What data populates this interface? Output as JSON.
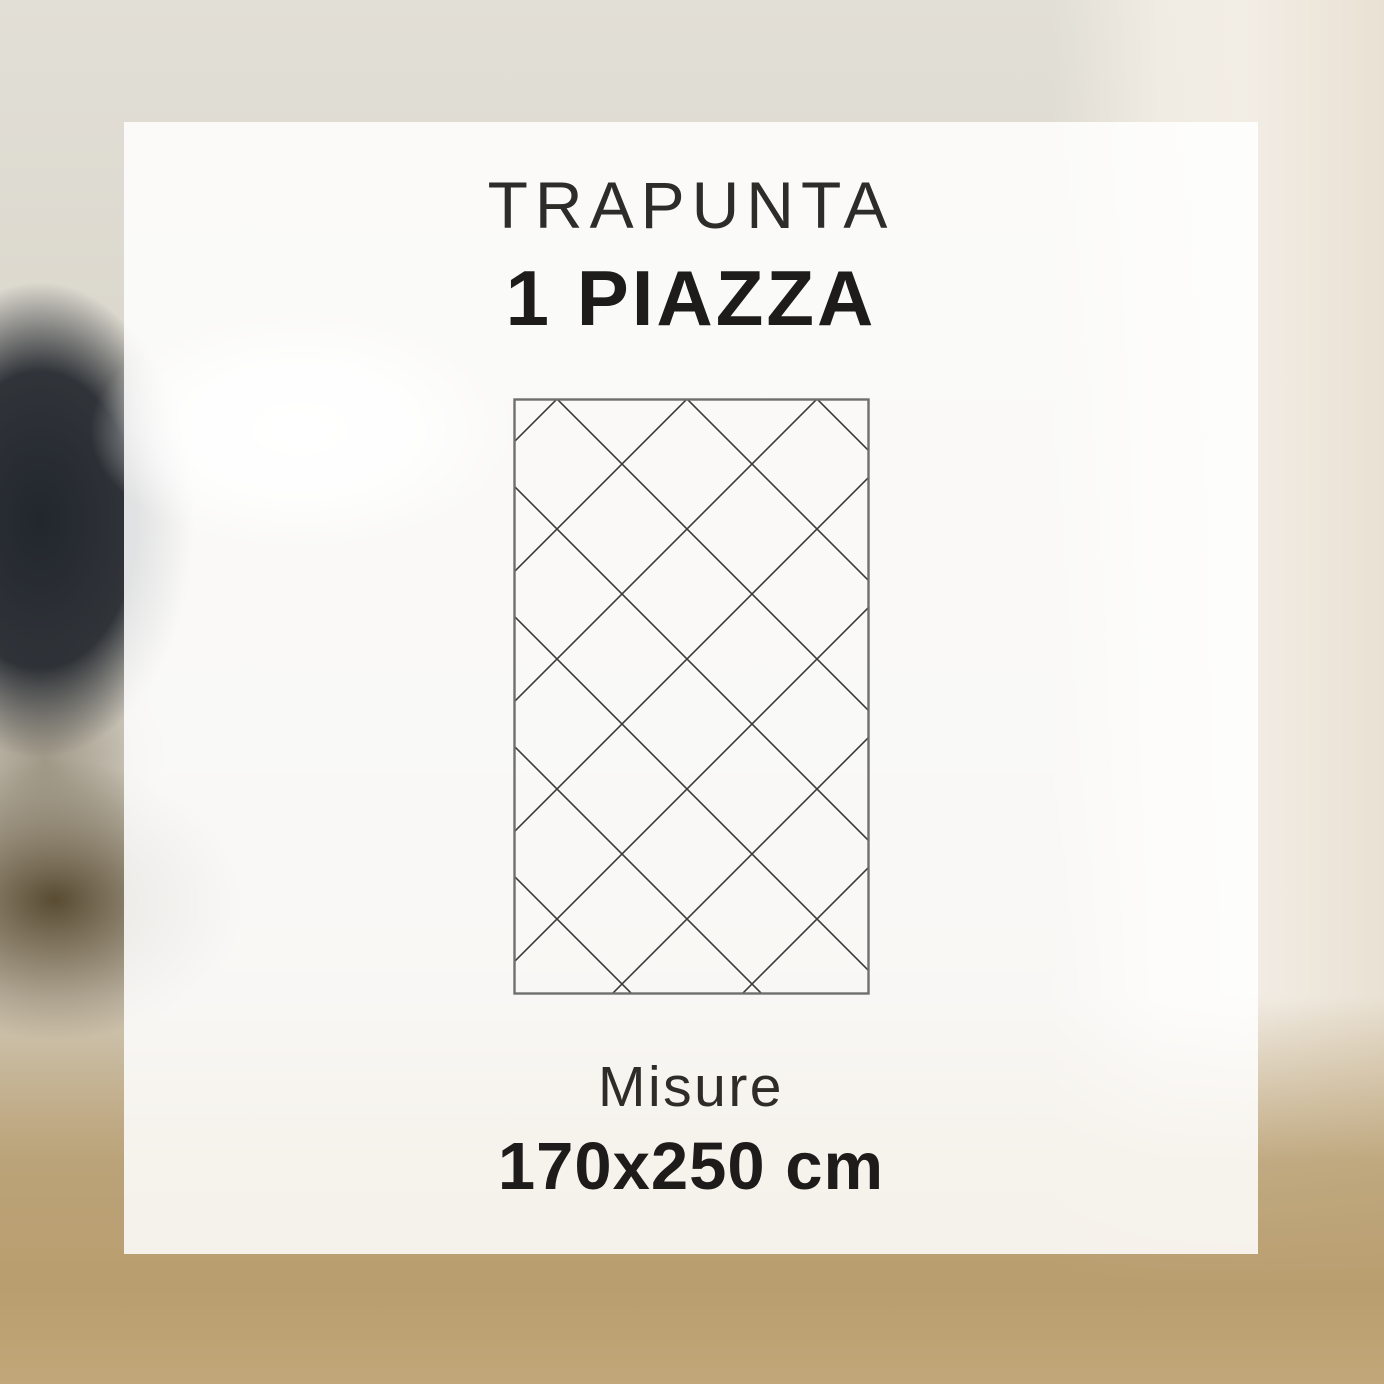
{
  "card": {
    "title": "TRAPUNTA",
    "subtitle": "1 PIAZZA",
    "measure_label": "Misure",
    "measure_value": "170x250 cm"
  },
  "diagram": {
    "icon": "quilt-diamond-pattern-icon",
    "border_color": "#6f6f6f",
    "stitch_line_color": "#3b3b3b"
  },
  "colors": {
    "text_primary": "#2e2c29",
    "text_emphasis": "#1d1c1a",
    "card_background": "#ffffff",
    "backdrop_beige": "#dedacf",
    "backdrop_tan": "#b99e6f",
    "backdrop_dark": "#1e232a",
    "backdrop_cream": "#f2ede5"
  }
}
